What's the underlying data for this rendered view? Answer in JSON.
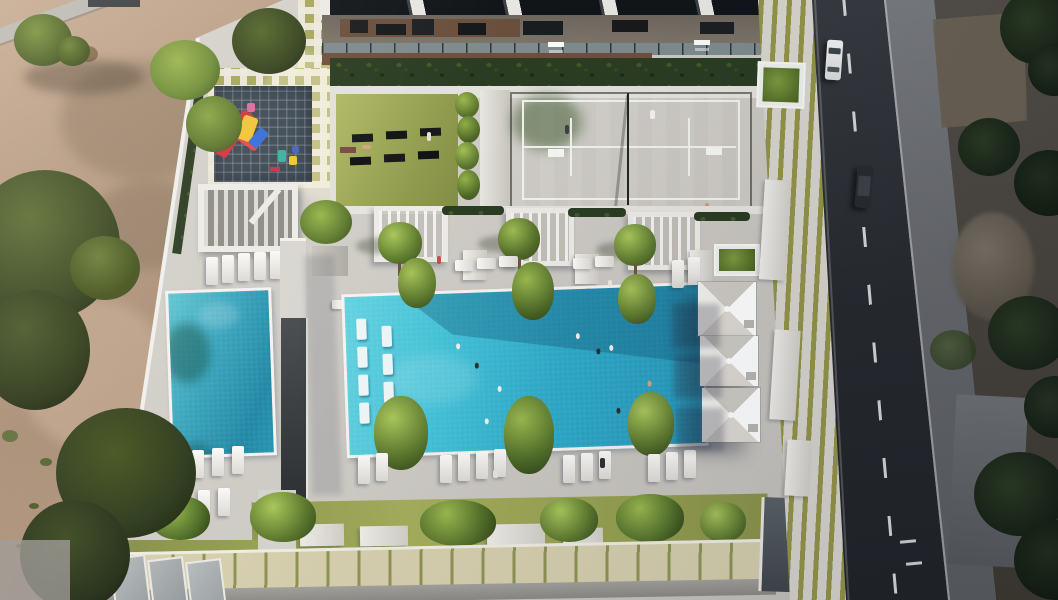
{
  "scene": {
    "type": "aerial-3d-architectural-render",
    "description": "Top-down aerial rendering of a residential building amenity podium: main swimming pool with in-water loungers and swimmers, secondary lap pool, paddle-tennis court with two players, outdoor gym lawn with exercise mats, children's playground on a dark safety mat, white slatted pergola, rows of sun loungers, three white pyramid umbrellas, landscaped planters and palm trees; desert scrub terrain on the left, an asphalt road with a white car and a dark car plus rocky scrubland on the right.",
    "inventory": {
      "pools": 2,
      "umbrellas": 3,
      "cars": 2,
      "tennis_players": 2,
      "playground_mats": 1,
      "gym_mats": 6,
      "pergolas_small": 3,
      "pergola_large": 1,
      "in_water_loungers": 7,
      "swimmers": 9
    }
  },
  "palette": {
    "deck_concrete": "#cfccc6",
    "sand": "#b49880",
    "pool_water_bright": "#3fc0d7",
    "pool_water_deep": "#2497b9",
    "court_green": "#7fb243",
    "lawn_olive": "#96a052",
    "hedge_dark": "#2a3c22",
    "tree_dark": "#35421f",
    "tree_light": "#9cb94f",
    "mat_navy": "#3f4b56",
    "play_red": "#d6333f",
    "play_yellow": "#f2c437",
    "play_blue": "#3a6fd8",
    "umbrella_white": "#f3f1ec",
    "road_asphalt": "#26292d",
    "lane_dash": "#d5d8d9",
    "car_white": "#f2f3f2",
    "car_dark": "#272b2e",
    "glass_facade": "#10151a"
  }
}
